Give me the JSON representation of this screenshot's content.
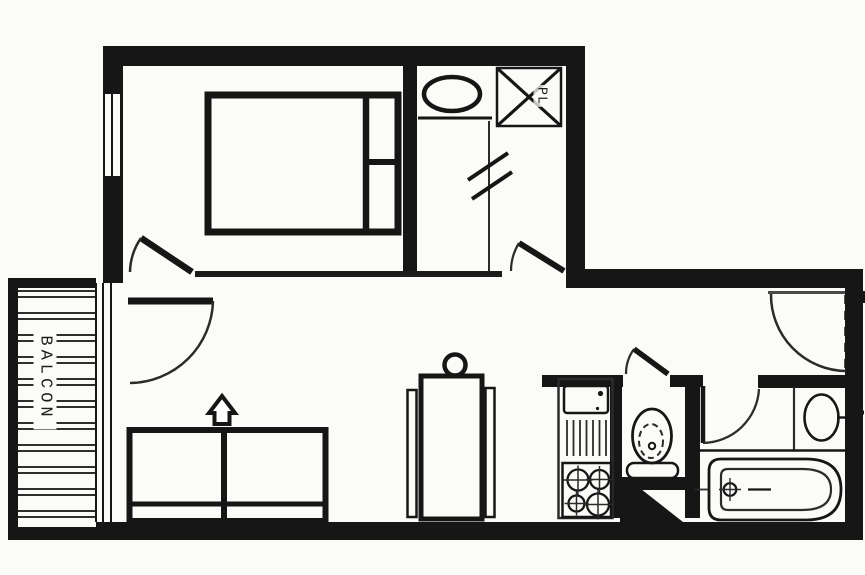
{
  "labels": {
    "balcony": "BALCON",
    "closet": "PL"
  },
  "colors": {
    "ink": "#161616",
    "line": "#2b2b2b",
    "paper": "#fbfbf8"
  },
  "fixtures": {
    "bedroom": [
      "double-bed-icon",
      "pillows-icon",
      "window-icon",
      "door-swing-icon"
    ],
    "entry_dressing": [
      "washbasin-icon",
      "wardrobe-cross-icon",
      "folding-partition-icon",
      "door-swing-icon"
    ],
    "living_room": [
      "sofa-bed-icon",
      "fold-out-arrow-icon",
      "dining-table-icon",
      "balcony-door-swing-icon"
    ],
    "balcony": [
      "decking-hatch-icon",
      "sliding-window-icon"
    ],
    "kitchen": [
      "sink-icon",
      "vent-grille-icon",
      "stove-four-burners-icon"
    ],
    "wc": [
      "toilet-icon",
      "door-swing-icon"
    ],
    "bathroom": [
      "washbasin-icon",
      "bathtub-icon",
      "door-swing-icon"
    ],
    "hall": [
      "entrance-door-swing-icon"
    ]
  }
}
